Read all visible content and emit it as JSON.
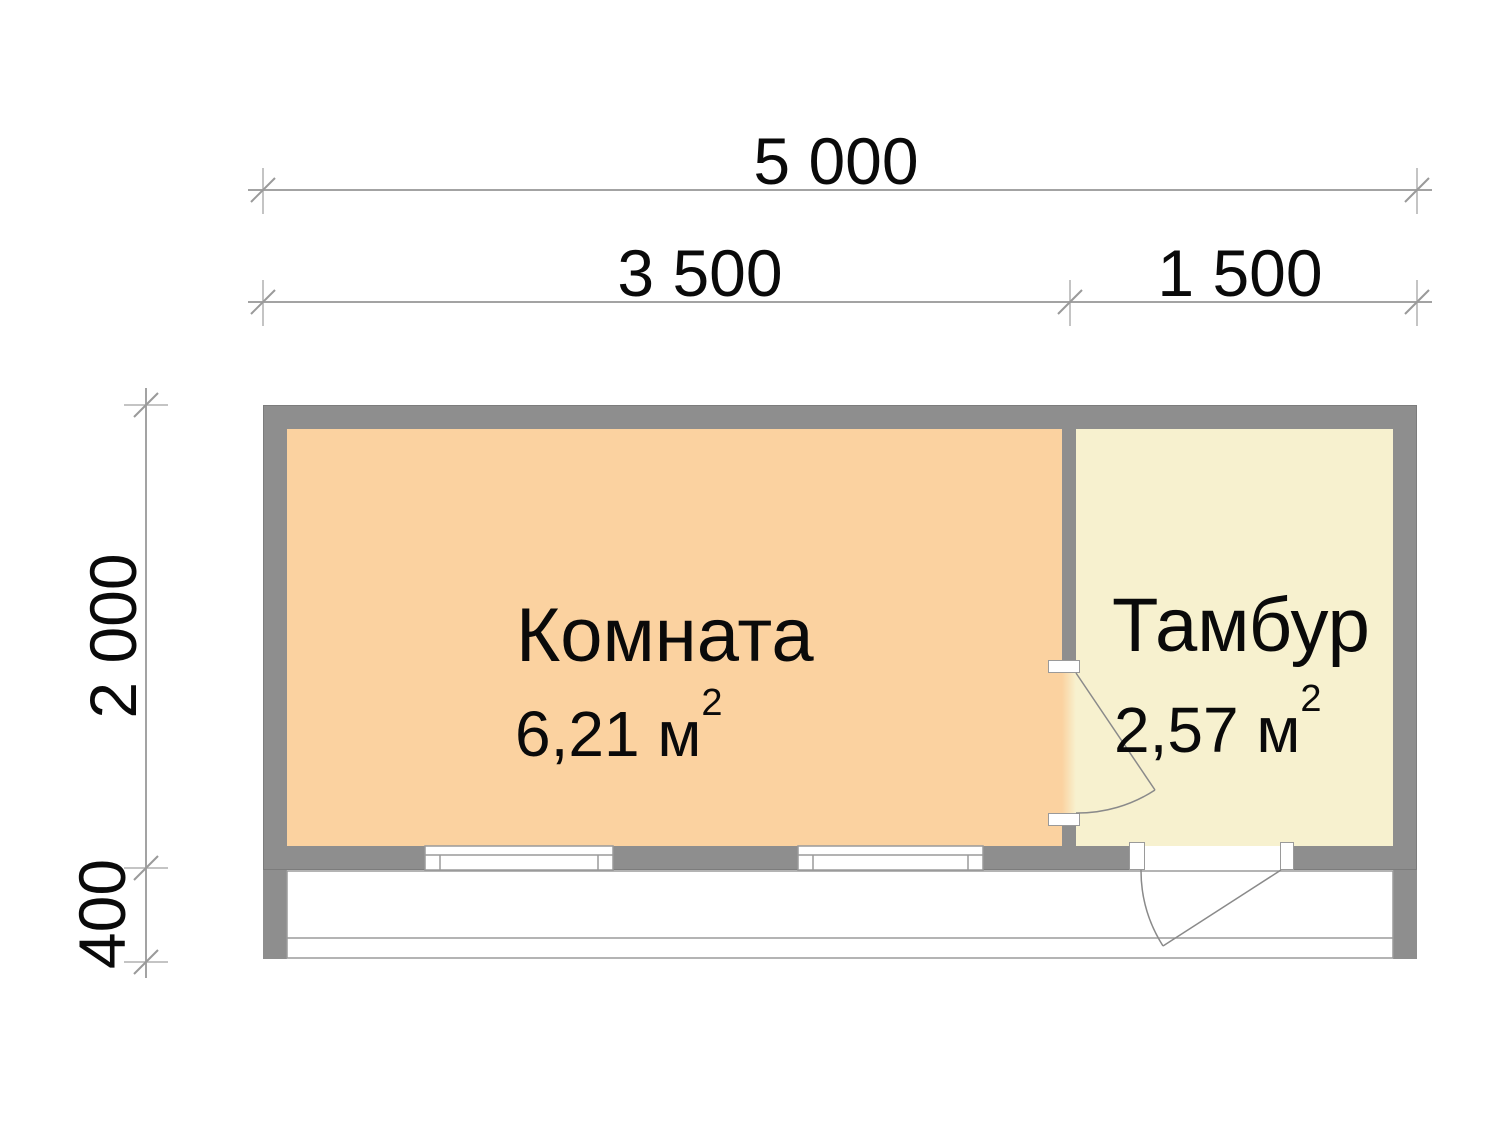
{
  "plan": {
    "rooms": [
      {
        "name": "Комната",
        "area": "6,21 м",
        "area_sup": "2"
      },
      {
        "name": "Тамбур",
        "area": "2,57 м",
        "area_sup": "2"
      }
    ],
    "dimensions": {
      "width_total": "5 000",
      "width_room": "3 500",
      "width_tambur": "1 500",
      "depth_building": "2 000",
      "depth_porch": "400"
    },
    "colors": {
      "wall": "#8E8E8E",
      "room1_fill": "#FBD2A0",
      "room2_fill": "#F7F1CF",
      "dim_line": "#A3A3A3",
      "door_line": "#8A8A8A",
      "text": "#0A0A0A",
      "background": "#FFFFFF"
    }
  }
}
